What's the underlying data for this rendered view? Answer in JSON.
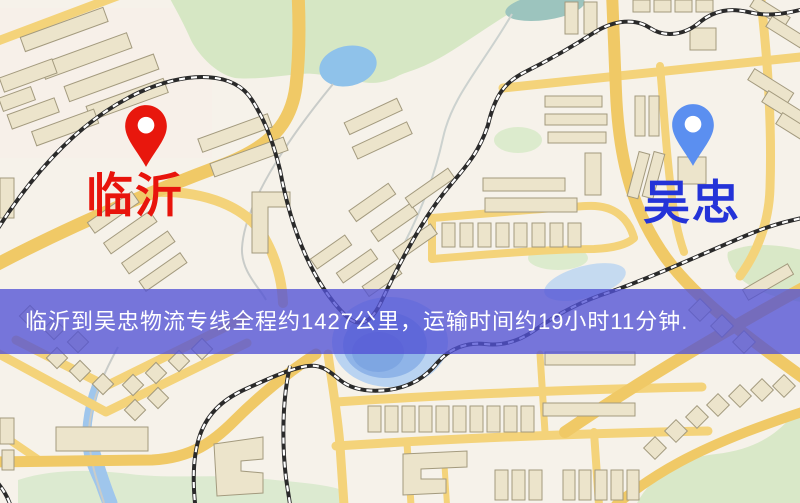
{
  "window": {
    "width": 800,
    "height": 503
  },
  "map": {
    "origin": {
      "label": "临沂",
      "pin_color": "#e8170d",
      "label_color": "#e8140c"
    },
    "destination": {
      "label": "吴忠",
      "pin_color": "#5b8ff0",
      "label_color": "#2433d8"
    }
  },
  "banner": {
    "text": "临沂到吴忠物流专线全程约1427公里，运输时间约19小时11分钟.",
    "background_color": "#5252d5",
    "opacity": 0.78,
    "text_color": "#ffffff",
    "route": {
      "from": "临沂",
      "to": "吴忠",
      "distance_km": 1427,
      "duration_hours": 19,
      "duration_minutes": 11
    }
  }
}
